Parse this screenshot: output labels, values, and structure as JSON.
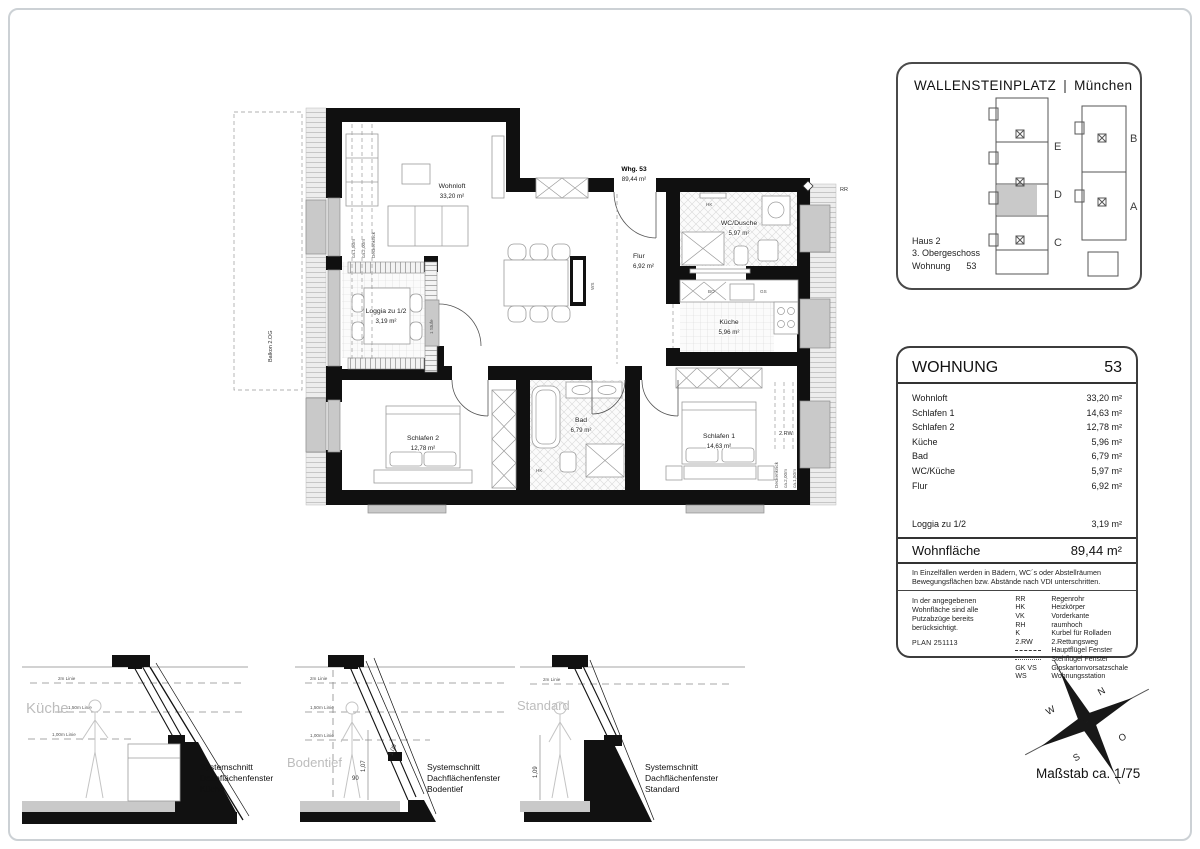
{
  "colors": {
    "wall": "#101010",
    "window_gray": "#c9c9c9",
    "roof_hatch_bg": "#ededed",
    "highlighted_unit": "#c9c9c9",
    "muted_label": "#bdbdbd",
    "frame_line": "#ccd1d5"
  },
  "title_block": {
    "project": "WALLENSTEINPLATZ",
    "separator": "|",
    "city": "München",
    "haus": "Haus 2",
    "floor": "3. Obergeschoss",
    "unit_label": "Wohnung",
    "unit_number": "53",
    "key_plan": {
      "left_units": [
        "E",
        "D",
        "C"
      ],
      "right_units": [
        "B",
        "A"
      ],
      "highlighted_unit": "D"
    }
  },
  "apartment_table": {
    "header_label": "WOHNUNG",
    "header_number": "53",
    "rooms": [
      {
        "name": "Wohnloft",
        "area": "33,20 m²"
      },
      {
        "name": "Schlafen 1",
        "area": "14,63 m²"
      },
      {
        "name": "Schlafen 2",
        "area": "12,78 m²"
      },
      {
        "name": "Küche",
        "area": "5,96 m²"
      },
      {
        "name": "Bad",
        "area": "6,79 m²"
      },
      {
        "name": "WC/Küche",
        "area": "5,97 m²"
      },
      {
        "name": "Flur",
        "area": "6,92 m²"
      }
    ],
    "loggia": {
      "name": "Loggia zu 1/2",
      "area": "3,19 m²"
    },
    "total": {
      "name": "Wohnfläche",
      "area": "89,44 m²"
    },
    "note_vdi": "In Einzelfällen werden in Bädern, WC´s oder Abstellräumen Bewegungsflächen bzw. Abstände nach VDI unterschritten.",
    "note_putz": "In der angegebenen Wohnfläche sind alle Putzabzüge bereits berücksichtigt.",
    "plan_number": "PLAN 251113",
    "legend": [
      {
        "abbr": "RR",
        "label": "Regenrohr"
      },
      {
        "abbr": "HK",
        "label": "Heizkörper"
      },
      {
        "abbr": "VK",
        "label": "Vorderkante"
      },
      {
        "abbr": "RH",
        "label": "raumhoch"
      },
      {
        "abbr": "K",
        "label": "Kurbel für Rolladen"
      },
      {
        "abbr": "2.RW",
        "label": "2.Rettungsweg"
      },
      {
        "abbr": "",
        "symbol": "dashed",
        "label": "Hauptflügel Fenster"
      },
      {
        "abbr": "",
        "symbol": "dotted",
        "label": "Stehflügel Fenster"
      },
      {
        "abbr": "GK VS",
        "label": "Gipskartonvorsatzschale"
      },
      {
        "abbr": "WS",
        "label": "Wohnungsstation"
      }
    ]
  },
  "floor_plan": {
    "apartment": {
      "label": "Whg. 53",
      "area": "89,44 m²"
    },
    "rooms": [
      {
        "name": "Wohnloft",
        "area": "33,20 m²"
      },
      {
        "name": "Flur",
        "area": "6,92 m²"
      },
      {
        "name": "WC/Dusche",
        "area": "5,97 m²"
      },
      {
        "name": "Küche",
        "area": "5,96 m²"
      },
      {
        "name": "Bad",
        "area": "6,79 m²"
      },
      {
        "name": "Schlafen 1",
        "area": "14,63 m²"
      },
      {
        "name": "Schlafen 2",
        "area": "12,78 m²"
      },
      {
        "name": "Loggia zu 1/2",
        "area": "3,19 m²"
      }
    ],
    "annotations": {
      "rr": "RR",
      "ws": "WS",
      "hk": "HK",
      "bo": "BO",
      "gs": "GS",
      "rw2": "2.RW",
      "balkon": "Balkon 2.OG",
      "deckenknick": "Deckenknick",
      "ca150": "ca.1,50m",
      "ca200": "ca.2,00m",
      "stufe": "1 Stufe"
    }
  },
  "sections": [
    {
      "room_label": "Küche",
      "caption": [
        "Systemschnitt",
        "Dachflächenfenster",
        "Küche"
      ],
      "height_lines": [
        "2m Linie",
        "1,50m Linie",
        "1,00m Linie"
      ],
      "dims": []
    },
    {
      "room_label": "Bodentief",
      "caption": [
        "Systemschnitt",
        "Dachflächenfenster",
        "Bodentief"
      ],
      "height_lines": [
        "2m Linie",
        "1,50m Linie",
        "1,00m Linie"
      ],
      "dims": [
        "1,07",
        "90",
        "1,00"
      ]
    },
    {
      "room_label": "Standard",
      "caption": [
        "Systemschnitt",
        "Dachflächenfenster",
        "Standard"
      ],
      "height_lines": [
        "2m Linie"
      ],
      "dims": [
        "1,09"
      ]
    }
  ],
  "compass": {
    "n": "N",
    "e": "O",
    "s": "S",
    "w": "W"
  },
  "scale_label": "Maßstab ca. 1/75"
}
